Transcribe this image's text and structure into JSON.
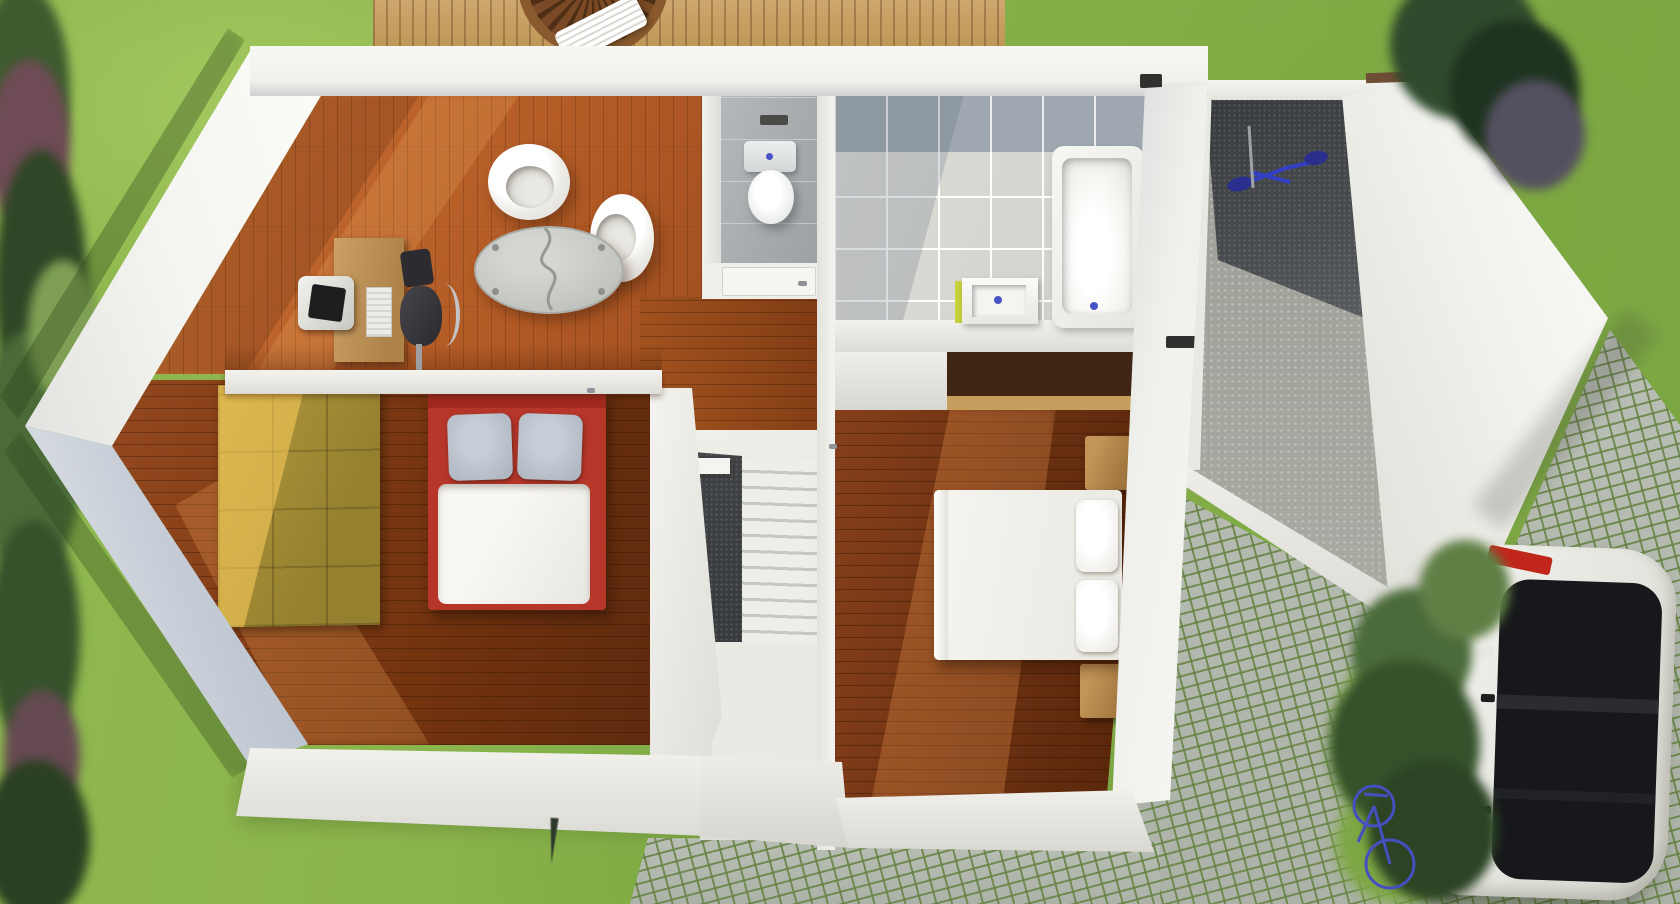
{
  "scene": {
    "description": "3D rendered top-down architectural floor plan of a house upper floor, set in a garden with lawn, hedges, wooden deck, garage, cobblestone driveway, parked white car and two blue bicycles",
    "style": "photorealistic 3D render, top-down axonometric view",
    "light_direction": "sunlight from upper right casting shadows toward lower left"
  },
  "palette": {
    "grass": "#87B14A",
    "grass_light": "#A3C75F",
    "grass_dark": "#6F9C3C",
    "hedge_green": "#35522B",
    "hedge_red": "#6E4B55",
    "wall_white": "#F2F1ED",
    "wall_shade": "#BAC2CD",
    "wood_living": "#B25A25",
    "wood_dark": "#72330F",
    "wood_deck": "#C9A368",
    "tile_floor": "#D8D8D4",
    "tile_band": "#9FA8B0",
    "wc_tile": "#ACB0B2",
    "stair_charcoal": "#3F4245",
    "gravel": "#A6A6A0",
    "cobble_stone": "#B7BCB4",
    "wardrobe_wood": "#A48C34",
    "bed1_frame_red": "#B7362A",
    "pillow_gray": "#B7BFC9",
    "linen_white": "#F3F2EE",
    "nightstand_wood": "#B08348",
    "counter_dark": "#3E2514",
    "counter_edge": "#C69E5E",
    "car_body": "#EFEFEA",
    "car_glass": "#17181B",
    "taillight_red": "#C1261A",
    "bike_blue": "#3440C4",
    "drain_blue": "#4953C8",
    "sink_side_lime": "#C8D23A"
  },
  "house": {
    "walls": "white",
    "rooms": [
      {
        "id": "office-living",
        "floor": "orange wood planks",
        "furniture": [
          "wooden desk",
          "computer monitor",
          "keyboard",
          "dark office chair",
          "white tub chair",
          "white tub chair",
          "oval glass coffee table"
        ]
      },
      {
        "id": "bedroom-1",
        "floor": "dark wood planks",
        "furniture": [
          "double bed with red frame",
          "two gray pillows",
          "white duvet",
          "yellow wooden wardrobe"
        ]
      },
      {
        "id": "wc",
        "floor": "gray tile",
        "furniture": [
          "toilet with cistern",
          "door"
        ]
      },
      {
        "id": "bathroom",
        "floor": "light gray tile with darker band",
        "furniture": [
          "bathtub",
          "square sink"
        ]
      },
      {
        "id": "bedroom-2",
        "floor": "dark wood planks",
        "furniture": [
          "white double bed",
          "two white pillows",
          "nightstand",
          "nightstand",
          "dark wood desk counter"
        ]
      },
      {
        "id": "staircase",
        "floor": "white landing",
        "features": [
          "straight flight",
          "winder steps",
          "charcoal tile strip",
          "white ledge"
        ]
      },
      {
        "id": "garage",
        "floor": "concrete and gravel",
        "contents": [
          "blue bicycle"
        ]
      }
    ]
  },
  "exterior": {
    "lawn": "green grass surrounding the house",
    "hedge_left": "dense trees and shrubs along left edge with reddish patches",
    "deck": {
      "material": "light wood planks",
      "items": [
        "round slatted table",
        "white striped lounger"
      ]
    },
    "driveway": {
      "material": "cobblestone with grass joints"
    },
    "car": {
      "color": "white",
      "glass": "black",
      "detail": "red taillight, parked on driveway"
    },
    "bicycles": [
      {
        "location": "garage",
        "color": "blue"
      },
      {
        "location": "driveway",
        "color": "blue"
      }
    ],
    "tree_top_right": "dark green tree overhanging garage",
    "bushes_bottom_right": "green shrubs beside car",
    "plant_stake": "small dark spike in grass below house"
  }
}
